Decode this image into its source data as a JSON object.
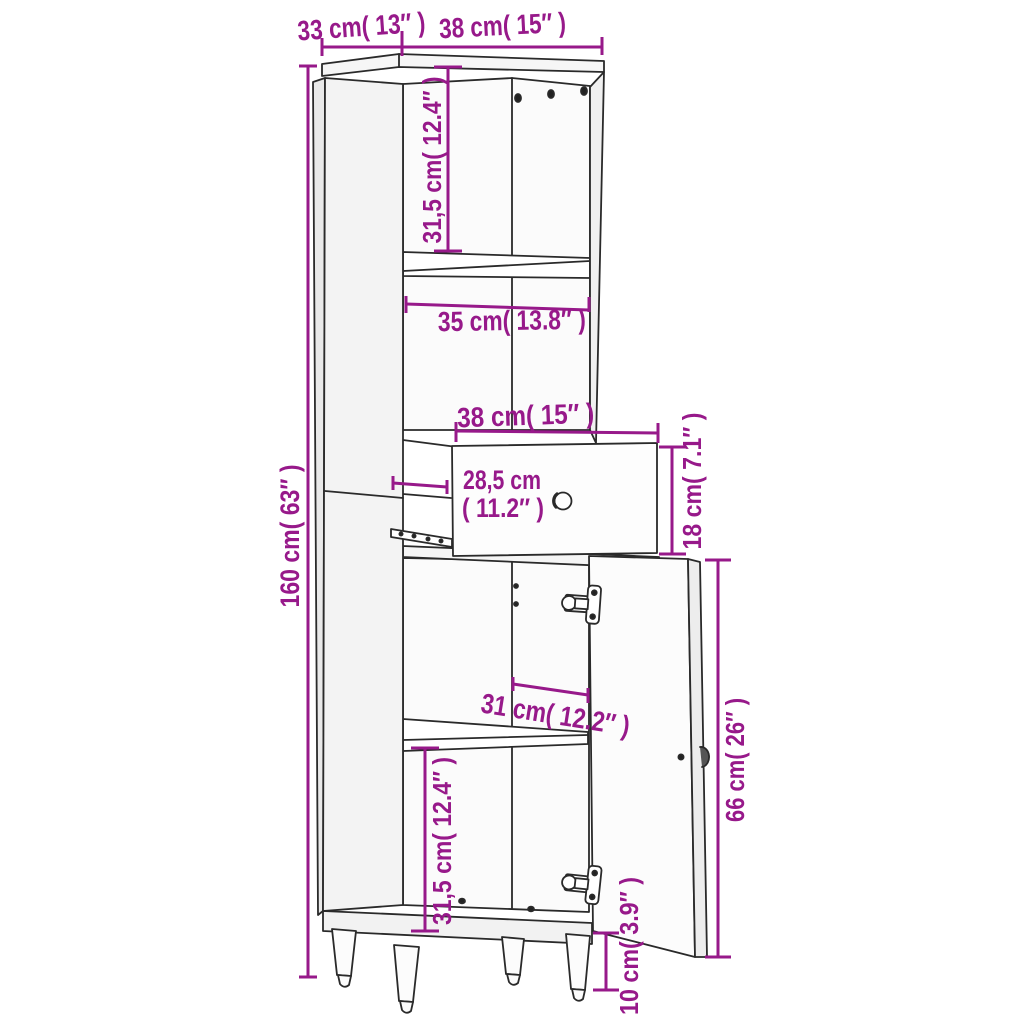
{
  "diagram": {
    "accent_color": "#97198a",
    "line_color": "#2a2a2a",
    "background": "#ffffff",
    "subject": "tall-cabinet-with-drawer-and-door",
    "dimensions": {
      "depth_top": "33 cm( 13″ )",
      "width_top": "38 cm( 15″ )",
      "upper_compartment_height": "31,5 cm( 12.4″ )",
      "shelf_width": "35 cm( 13.8″ )",
      "drawer_width": "38 cm( 15″ )",
      "drawer_depth_value": "28,5 cm",
      "drawer_depth_inches": "( 11.2″ )",
      "drawer_height": "18 cm( 7.1″ )",
      "total_height": "160 cm( 63″ )",
      "lower_shelf_width": "31 cm( 12.2″ )",
      "door_height": "66 cm( 26″ )",
      "lower_compartment_height": "31,5 cm( 12.4″ )",
      "leg_height": "10 cm( 3.9″ )"
    }
  }
}
